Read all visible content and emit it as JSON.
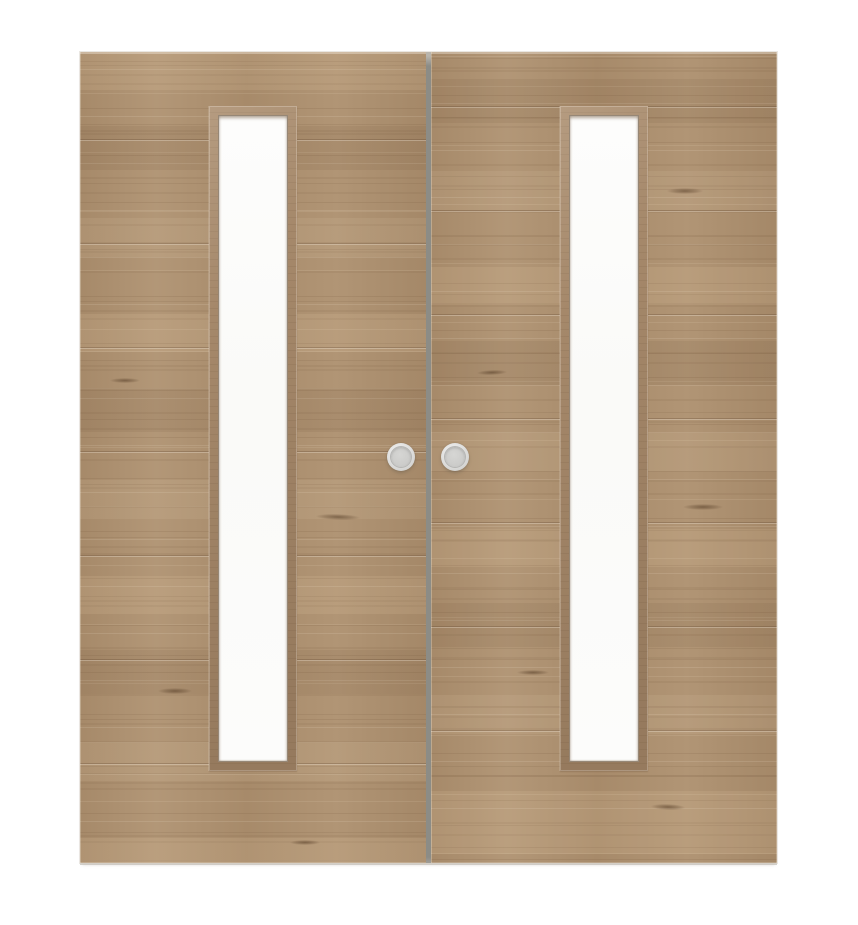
{
  "scene": {
    "description": "Product photograph of a pair of light oak veneer double doors, each with a narrow full-height white glazed panel in a wooden frame and a round flush pull handle near the centre meeting edge, shown closed on a plain white background",
    "door_count": 2,
    "glass_panel_count": 2,
    "handle_count": 2
  },
  "colors": {
    "bg": "#ffffff",
    "wood-base": "#ac8f6e",
    "wood-light": "#c2a686",
    "wood-dark": "#8a6e50",
    "plank-line": "rgba(84,58,37,0.26)",
    "plank-glint": "rgba(255,248,238,0.28)",
    "frame-face": "#a5886a",
    "frame-inner": "rgba(96,72,46,0.65)",
    "glass": "#fcfcfb",
    "glass-shadow": "rgba(108,84,58,0.5)",
    "seam": "#8c8c86",
    "edge-light": "rgba(255,250,242,0.35)",
    "under-shadow": "rgba(198,193,185,0.75)",
    "handle-ring": "#e6e6e5",
    "handle-face": "#d3d3d1",
    "handle-recess": "#cbcbc9",
    "handle-edge": "#b5b5b3"
  }
}
